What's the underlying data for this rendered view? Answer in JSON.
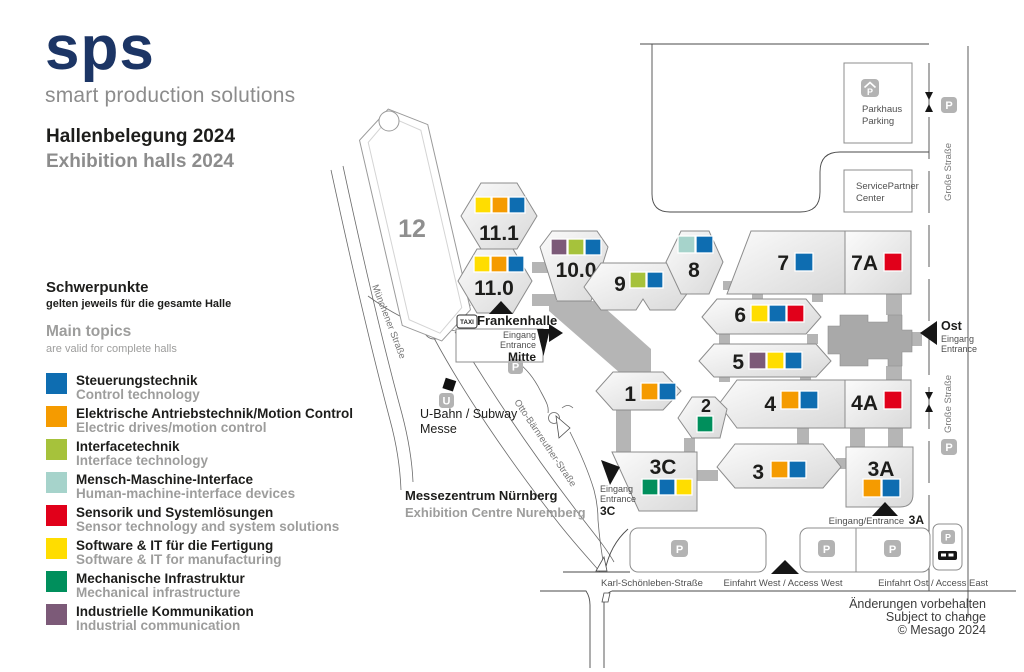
{
  "brand": {
    "logo": "sps",
    "tagline": "smart production solutions"
  },
  "title": {
    "de": "Hallenbelegung 2024",
    "en": "Exhibition halls 2024"
  },
  "intro": {
    "de_head": "Schwerpunkte",
    "de_sub": "gelten jeweils für die gesamte Halle",
    "en_head": "Main topics",
    "en_sub": "are valid for complete halls"
  },
  "colors": {
    "control": "#0e6db1",
    "drives": "#f59b00",
    "interface": "#a6c23b",
    "hmi": "#a6d3cb",
    "sensor": "#e1001a",
    "software": "#ffdd00",
    "mech": "#008f5c",
    "comm": "#7c5a78"
  },
  "legend": [
    {
      "key": "control",
      "de": "Steuerungstechnik",
      "en": "Control technology"
    },
    {
      "key": "drives",
      "de": "Elektrische Antriebstechnik/Motion Control",
      "en": "Electric drives/motion control"
    },
    {
      "key": "interface",
      "de": "Interfacetechnik",
      "en": "Interface technology"
    },
    {
      "key": "hmi",
      "de": "Mensch-Maschine-Interface",
      "en": "Human-machine-interface devices"
    },
    {
      "key": "sensor",
      "de": "Sensorik und Systemlösungen",
      "en": "Sensor technology and system solutions"
    },
    {
      "key": "software",
      "de": "Software & IT für die Fertigung",
      "en": "Software & IT for manufacturing"
    },
    {
      "key": "mech",
      "de": "Mechanische Infrastruktur",
      "en": "Mechanical infrastructure"
    },
    {
      "key": "comm",
      "de": "Industrielle Kommunikation",
      "en": "Industrial communication"
    }
  ],
  "halls": {
    "h12": {
      "label": "12",
      "topics": []
    },
    "h11_1": {
      "label": "11.1",
      "topics": [
        "software",
        "drives",
        "control"
      ]
    },
    "h11_0": {
      "label": "11.0",
      "topics": [
        "software",
        "drives",
        "control"
      ]
    },
    "h10_0": {
      "label": "10.0",
      "topics": [
        "comm",
        "interface",
        "control"
      ]
    },
    "h9": {
      "label": "9",
      "topics": [
        "interface",
        "control"
      ]
    },
    "h8": {
      "label": "8",
      "topics": [
        "hmi",
        "control"
      ]
    },
    "h7": {
      "label": "7",
      "topics": [
        "control"
      ]
    },
    "h7a": {
      "label": "7A",
      "topics": [
        "sensor"
      ]
    },
    "h6": {
      "label": "6",
      "topics": [
        "software",
        "control",
        "sensor"
      ]
    },
    "h5": {
      "label": "5",
      "topics": [
        "comm",
        "software",
        "control"
      ]
    },
    "h4": {
      "label": "4",
      "topics": [
        "drives",
        "control"
      ]
    },
    "h4a": {
      "label": "4A",
      "topics": [
        "sensor"
      ]
    },
    "h1": {
      "label": "1",
      "topics": [
        "drives",
        "control"
      ]
    },
    "h2": {
      "label": "2",
      "topics": [
        "mech"
      ]
    },
    "h3": {
      "label": "3",
      "topics": [
        "drives",
        "control"
      ]
    },
    "h3c": {
      "label": "3C",
      "topics": [
        "mech",
        "control",
        "software"
      ]
    },
    "h3a": {
      "label": "3A",
      "topics": [
        "drives",
        "control"
      ]
    }
  },
  "labels": {
    "parkhaus1": "Parkhaus",
    "parkhaus2": "Parking",
    "service1": "ServicePartner",
    "service2": "Center",
    "grosse": "Große Straße",
    "ost": "Ost",
    "eingang": "Eingang",
    "entrance": "Entrance",
    "mitte": "Mitte",
    "frankenhalle": "Frankenhalle",
    "taxi": "TAXI",
    "p": "P",
    "u": "U",
    "ubahn1": "U-Bahn / Subway",
    "ubahn2": "Messe",
    "otto": "Otto-Bärnreuther-Straße",
    "muenchener": "Münchener Straße",
    "messezentrum_de": "Messezentrum Nürnberg",
    "messezentrum_en": "Exhibition Centre Nuremberg",
    "eingang_entrance": "Eingang/Entrance",
    "c3": "3C",
    "a3": "3A",
    "karl": "Karl-Schönleben-Straße",
    "west": "Einfahrt West / Access West",
    "east": "Einfahrt Ost / Access East",
    "footer1": "Änderungen vorbehalten",
    "footer2": "Subject to change",
    "footer3": "© Mesago 2024"
  }
}
